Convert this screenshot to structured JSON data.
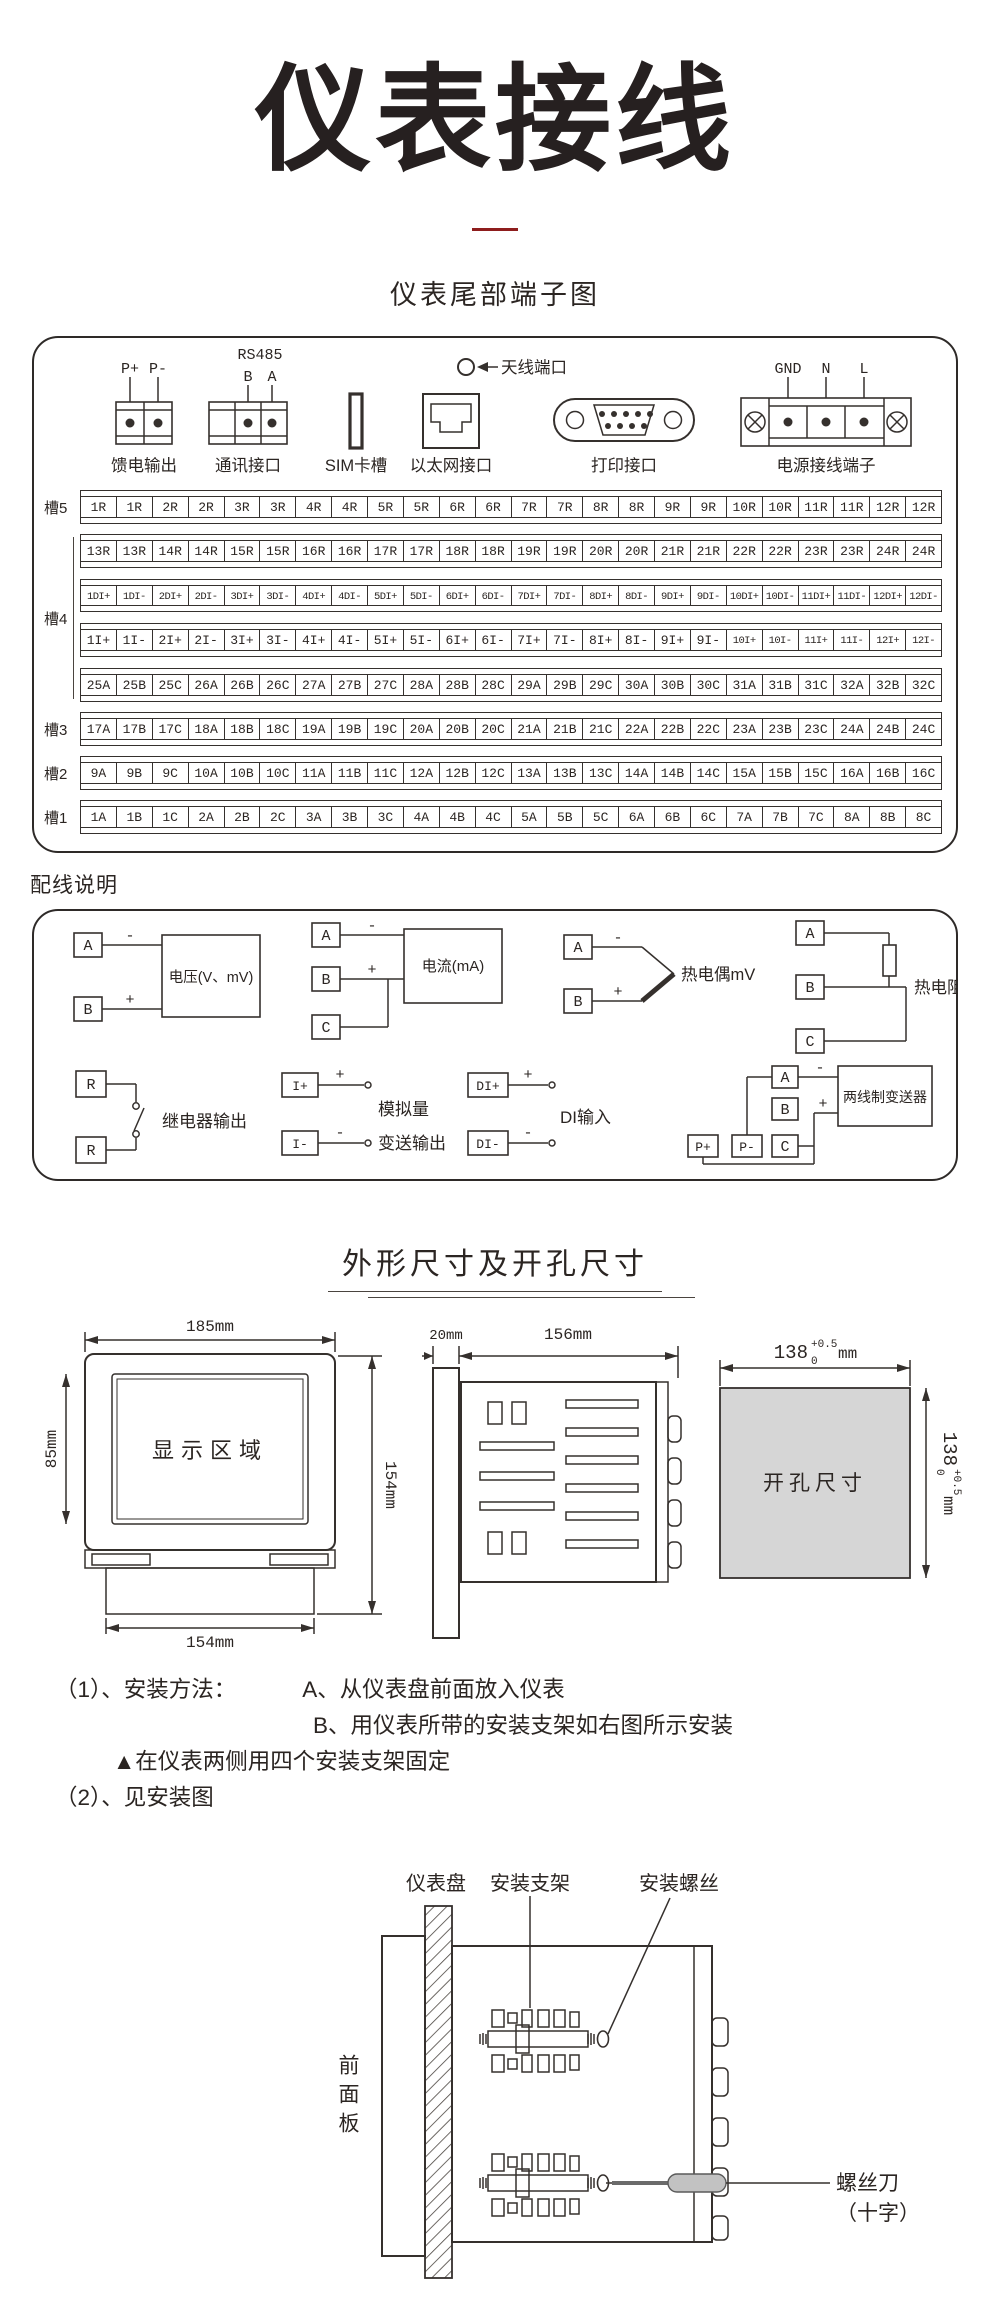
{
  "page": {
    "title": "仪表接线",
    "subtitle": "仪表尾部端子图",
    "wiring_title": "配线说明",
    "dims_title": "外形尺寸及开孔尺寸"
  },
  "colors": {
    "accent_red": "#8e1d1d",
    "line": "#35302d",
    "gray_fill": "#d6d6d6"
  },
  "connectors": {
    "feed": {
      "label": "馈电输出",
      "pins": [
        "P+",
        "P-"
      ]
    },
    "comm": {
      "label": "通讯接口",
      "title": "RS485",
      "pins": [
        "B",
        "A"
      ]
    },
    "sim": {
      "label": "SIM卡槽"
    },
    "ethernet": {
      "label": "以太网接口"
    },
    "antenna": {
      "label": "天线端口"
    },
    "printer": {
      "label": "打印接口"
    },
    "power": {
      "label": "电源接线端子",
      "pins": [
        "GND",
        "N",
        "L"
      ]
    }
  },
  "terminals": {
    "slots": [
      {
        "label": "槽5",
        "rows": [
          [
            "1R",
            "1R",
            "2R",
            "2R",
            "3R",
            "3R",
            "4R",
            "4R",
            "5R",
            "5R",
            "6R",
            "6R",
            "7R",
            "7R",
            "8R",
            "8R",
            "9R",
            "9R",
            "10R",
            "10R",
            "11R",
            "11R",
            "12R",
            "12R"
          ]
        ]
      },
      {
        "label": "槽4",
        "rows": [
          [
            "13R",
            "13R",
            "14R",
            "14R",
            "15R",
            "15R",
            "16R",
            "16R",
            "17R",
            "17R",
            "18R",
            "18R",
            "19R",
            "19R",
            "20R",
            "20R",
            "21R",
            "21R",
            "22R",
            "22R",
            "23R",
            "23R",
            "24R",
            "24R"
          ],
          [
            "1DI+",
            "1DI-",
            "2DI+",
            "2DI-",
            "3DI+",
            "3DI-",
            "4DI+",
            "4DI-",
            "5DI+",
            "5DI-",
            "6DI+",
            "6DI-",
            "7DI+",
            "7DI-",
            "8DI+",
            "8DI-",
            "9DI+",
            "9DI-",
            "10DI+",
            "10DI-",
            "11DI+",
            "11DI-",
            "12DI+",
            "12DI-"
          ],
          [
            "1I+",
            "1I-",
            "2I+",
            "2I-",
            "3I+",
            "3I-",
            "4I+",
            "4I-",
            "5I+",
            "5I-",
            "6I+",
            "6I-",
            "7I+",
            "7I-",
            "8I+",
            "8I-",
            "9I+",
            "9I-",
            "10I+",
            "10I-",
            "11I+",
            "11I-",
            "12I+",
            "12I-"
          ],
          [
            "25A",
            "25B",
            "25C",
            "26A",
            "26B",
            "26C",
            "27A",
            "27B",
            "27C",
            "28A",
            "28B",
            "28C",
            "29A",
            "29B",
            "29C",
            "30A",
            "30B",
            "30C",
            "31A",
            "31B",
            "31C",
            "32A",
            "32B",
            "32C"
          ]
        ]
      },
      {
        "label": "槽3",
        "rows": [
          [
            "17A",
            "17B",
            "17C",
            "18A",
            "18B",
            "18C",
            "19A",
            "19B",
            "19C",
            "20A",
            "20B",
            "20C",
            "21A",
            "21B",
            "21C",
            "22A",
            "22B",
            "22C",
            "23A",
            "23B",
            "23C",
            "24A",
            "24B",
            "24C"
          ]
        ]
      },
      {
        "label": "槽2",
        "rows": [
          [
            "9A",
            "9B",
            "9C",
            "10A",
            "10B",
            "10C",
            "11A",
            "11B",
            "11C",
            "12A",
            "12B",
            "12C",
            "13A",
            "13B",
            "13C",
            "14A",
            "14B",
            "14C",
            "15A",
            "15B",
            "15C",
            "16A",
            "16B",
            "16C"
          ]
        ]
      },
      {
        "label": "槽1",
        "rows": [
          [
            "1A",
            "1B",
            "1C",
            "2A",
            "2B",
            "2C",
            "3A",
            "3B",
            "3C",
            "4A",
            "4B",
            "4C",
            "5A",
            "5B",
            "5C",
            "6A",
            "6B",
            "6C",
            "7A",
            "7B",
            "7C",
            "8A",
            "8B",
            "8C"
          ]
        ]
      }
    ]
  },
  "wiring": {
    "signs": {
      "plus": "+",
      "minus": "-"
    },
    "voltage": {
      "a": "A",
      "b": "B",
      "label": "电压(V、mV)"
    },
    "current": {
      "a": "A",
      "b": "B",
      "c": "C",
      "label": "电流(mA)"
    },
    "thermocouple": {
      "a": "A",
      "b": "B",
      "label": "热电偶mV"
    },
    "rtd": {
      "a": "A",
      "b": "B",
      "c": "C",
      "label": "热电阻"
    },
    "relay": {
      "r1": "R",
      "r2": "R",
      "label": "继电器输出"
    },
    "analog": {
      "p1": "I+",
      "p2": "I-",
      "label1": "模拟量",
      "label2": "变送输出"
    },
    "di": {
      "p1": "DI+",
      "p2": "DI-",
      "label": "DI输入"
    },
    "transmitter": {
      "a": "A",
      "b": "B",
      "c": "C",
      "pp": "P+",
      "pm": "P-",
      "label": "两线制变送器"
    }
  },
  "dimensions": {
    "front": {
      "top": "185mm",
      "screen": "显示区域",
      "screen_h": "85mm",
      "right": "154mm",
      "bottom": "154mm"
    },
    "side": {
      "panel": "20mm",
      "depth": "156mm"
    },
    "cutout": {
      "label": "开孔尺寸",
      "base": "138",
      "tol_plus": "+0.5",
      "tol_minus": "0",
      "unit": "mm"
    }
  },
  "install": {
    "line1_prefix": "（1）、安装方法：",
    "line1_a": "A、从仪表盘前面放入仪表",
    "line2_b": "B、用仪表所带的安装支架如右图所示安装",
    "line3": "▲在仪表两侧用四个安装支架固定",
    "line4": "（2）、见安装图",
    "diagram": {
      "panel": "仪表盘",
      "bracket": "安装支架",
      "screw": "安装螺丝",
      "front_panel": "前面板",
      "driver1": "螺丝刀",
      "driver2": "（十字）"
    }
  }
}
